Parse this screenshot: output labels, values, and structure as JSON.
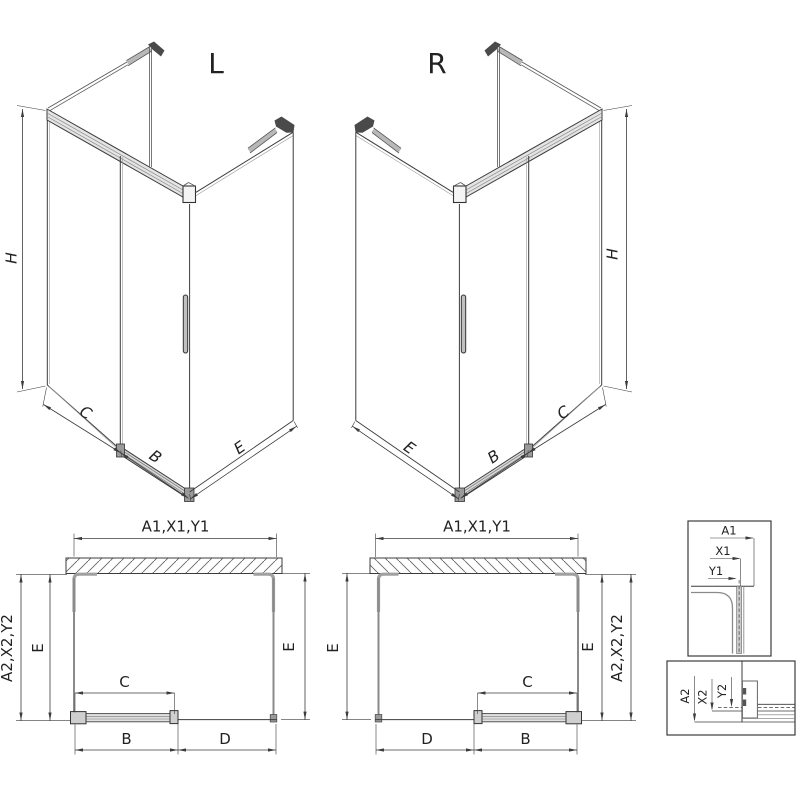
{
  "drawing": {
    "type": "shower-enclosure-technical-drawing",
    "views": {
      "iso_l": {
        "label": "L",
        "dim_h": "H",
        "dim_c": "C",
        "dim_b": "B",
        "dim_e": "E"
      },
      "iso_r": {
        "label": "R",
        "dim_h": "H",
        "dim_c": "C",
        "dim_b": "B",
        "dim_e": "E"
      },
      "plan_l": {
        "dim_top": "A1,X1,Y1",
        "dim_side": "A2,X2,Y2",
        "dim_e_left": "E",
        "dim_e_right": "E",
        "dim_c": "C",
        "dim_b": "B",
        "dim_d": "D"
      },
      "plan_r": {
        "dim_top": "A1,X1,Y1",
        "dim_side": "A2,X2,Y2",
        "dim_e_left": "E",
        "dim_e_right": "E",
        "dim_c": "C",
        "dim_b": "B",
        "dim_d": "D"
      },
      "detail_top": {
        "dim_a1": "A1",
        "dim_x1": "X1",
        "dim_y1": "Y1"
      },
      "detail_bottom": {
        "dim_a2": "A2",
        "dim_x2": "X2",
        "dim_y2": "Y2"
      }
    },
    "colors": {
      "line": "#3c3c3c",
      "glass": "#8a8a8a",
      "profile": "#a0a0a0",
      "dark": "#4a4a4a",
      "fill_light": "#e0e0e0"
    }
  }
}
